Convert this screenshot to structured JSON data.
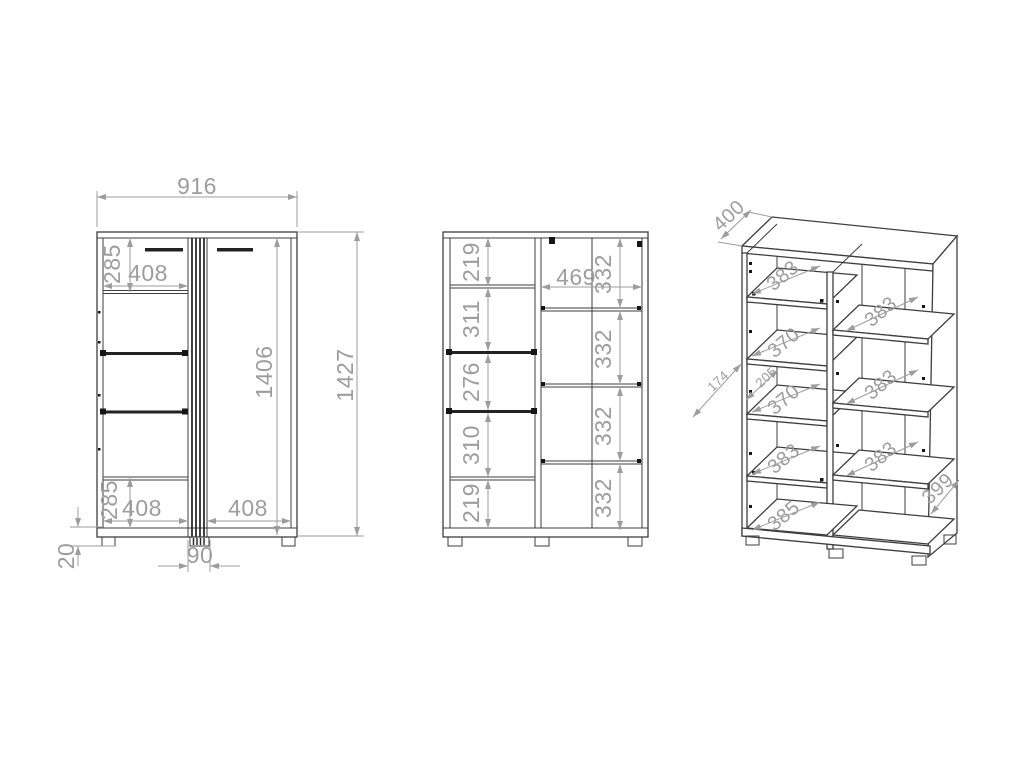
{
  "colors": {
    "background": "#ffffff",
    "outline": "#3e3e3e",
    "dimension_lines": "#9d9d9d",
    "dimension_text": "#9d9d9d",
    "hardware_pins": "#161616"
  },
  "views": {
    "front_exterior": {
      "dims": {
        "width_total": "916",
        "top_left_height": "285",
        "top_left_width": "408",
        "interior_height": "1406",
        "total_height": "1427",
        "bottom_left_height": "285",
        "bottom_left_width": "408",
        "bottom_right_width": "408",
        "foot_height": "20",
        "center_strip_width": "90"
      }
    },
    "front_interior": {
      "left_sections": [
        "219",
        "311",
        "276",
        "310",
        "219"
      ],
      "right_width": "469",
      "right_sections": [
        "332",
        "332",
        "332",
        "332"
      ]
    },
    "isometric": {
      "top_depth": "400",
      "left_shelf_depths": [
        "383",
        "370",
        "370",
        "383",
        "385"
      ],
      "right_shelf_depths": [
        "383",
        "383",
        "383"
      ],
      "detail_dims": [
        "174",
        "205"
      ],
      "side_depth": "399"
    }
  }
}
